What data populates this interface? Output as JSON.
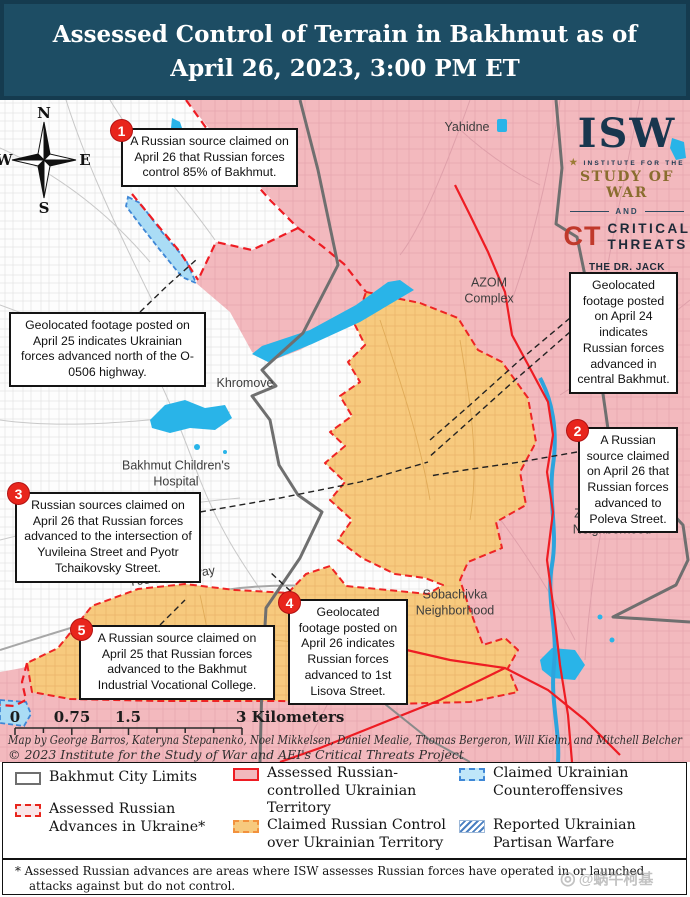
{
  "header": {
    "line1": "Assessed Control of Terrain in Bakhmut as of",
    "line2": "April 26, 2023, 3:00 PM ET"
  },
  "compass": {
    "n": "N",
    "e": "E",
    "s": "S",
    "w": "W"
  },
  "logo": {
    "isw": "ISW",
    "star": "★",
    "institute_line1": "INSTITUTE FOR THE",
    "institute_line2": "STUDY OF WAR",
    "and": "AND",
    "ct": "CT",
    "critical": "CRITICAL",
    "threats": "THREATS",
    "fund_line1": "THE DR. JACK LONDON",
    "fund_line2": "GEOSPATIAL FUND"
  },
  "numbered_annotations": [
    {
      "num": "1",
      "text": "A Russian source claimed on April 26 that Russian forces control 85% of Bakhmut."
    },
    {
      "num": "2",
      "text": "A Russian source claimed on April 26 that Russian forces advanced to Poleva Street."
    },
    {
      "num": "3",
      "text": "Russian sources claimed on April 26 that Russian forces advanced to the intersection of Yuvileina Street and Pyotr Tchaikovsky Street."
    },
    {
      "num": "4",
      "text": "Geolocated footage posted on April 26 indicates Russian forces advanced to 1st Lisova Street."
    },
    {
      "num": "5",
      "text": "A Russian source claimed on April 25 that Russian forces advanced to the Bakhmut Industrial Vocational College."
    }
  ],
  "callouts": [
    {
      "text": "Geolocated footage posted on April 25 indicates Ukrainian forces advanced north of the O-0506 highway."
    },
    {
      "text": "Geolocated footage posted on April 24 indicates Russian forces advanced in central Bakhmut."
    }
  ],
  "map_labels": {
    "yahidne": "Yahidne",
    "azom_line1": "AZOM",
    "azom_line2": "Complex",
    "khromove": "Khromove",
    "hospital_line1": "Bakhmut Children's",
    "hospital_line2": "Hospital",
    "highway": "T0504 Highway",
    "zabakhmutka_line1": "Zabakhmutka",
    "zabakhmutka_line2": "Neighborhood",
    "sobachivka_line1": "Sobachivka",
    "sobachivka_line2": "Neighborhood"
  },
  "scalebar": {
    "v0": "0",
    "v1": "0.75",
    "v2": "1.5",
    "v3": "3 Kilometers"
  },
  "attribution": {
    "line1": "Map by George Barros, Kateryna Stepanenko, Noel Mikkelsen, Daniel Mealie, Thomas Bergeron, Will Kielm, and Mitchell Belcher",
    "line2": "© 2023 Institute for the Study of War and AEI's Critical Threats Project"
  },
  "legend": {
    "items": [
      {
        "label": "Bakhmut City Limits"
      },
      {
        "label": "Assessed Russian Advances in Ukraine*"
      },
      {
        "label": "Assessed Russian-controlled Ukrainian Territory"
      },
      {
        "label": "Claimed Russian Control over Ukrainian Territory"
      },
      {
        "label": "Claimed Ukrainian Counteroffensives"
      },
      {
        "label": "Reported Ukrainian Partisan Warfare"
      }
    ]
  },
  "footnote": "* Assessed Russian advances are areas where ISW assesses Russian forces have operated in or launched attacks against but do not control.",
  "watermark": {
    "icon": "◎",
    "text": "@蜗牛柯基"
  },
  "colors": {
    "header_bg": "#1d4d64",
    "russian_controlled": "#f3b9be",
    "claimed_russian_control": "#f7ca7e",
    "counteroffensive": "#aadcf5",
    "water": "#29b4e8",
    "front_line_red": "#ee1c23",
    "city_limits_gray": "#6f6f6f"
  }
}
